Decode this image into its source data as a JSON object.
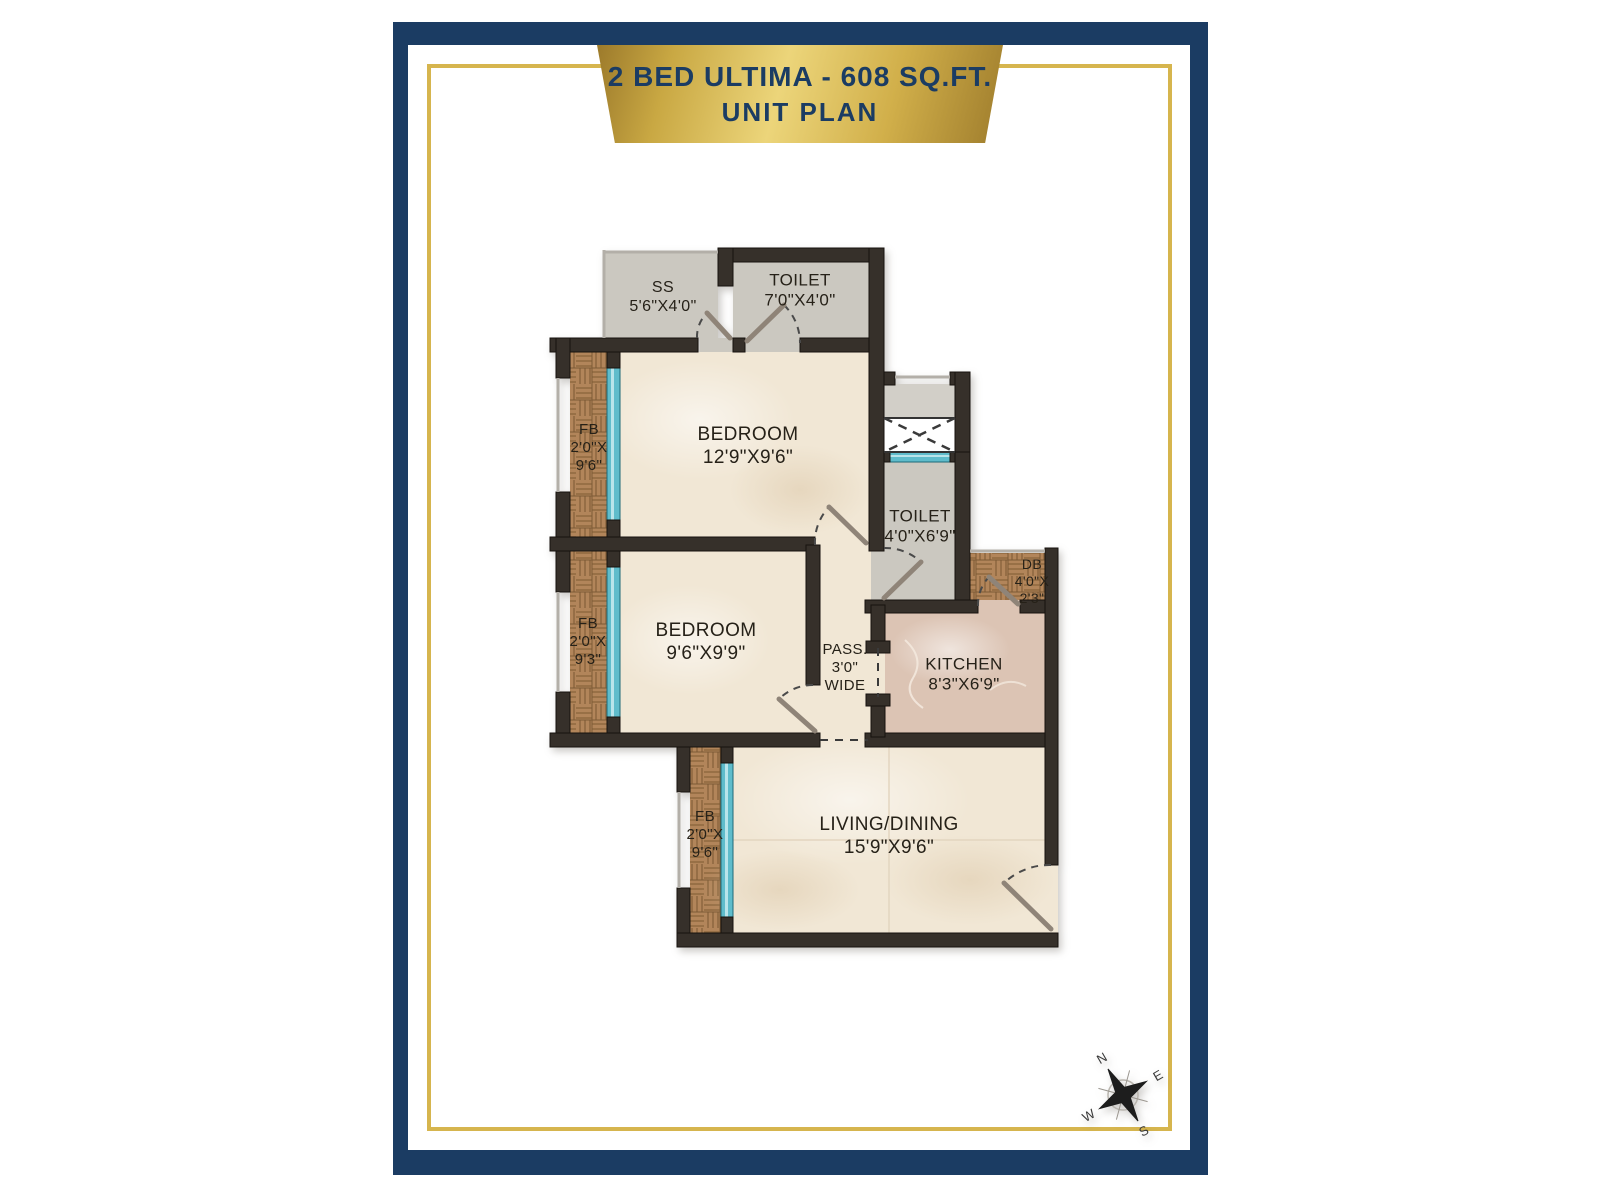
{
  "title": {
    "line1": "2 BED ULTIMA - 608 SQ.FT.",
    "line2": "UNIT PLAN"
  },
  "rooms": {
    "ss": {
      "lines": [
        "SS",
        "5'6\"X4'0\""
      ]
    },
    "toilet1": {
      "lines": [
        "TOILET",
        "7'0\"X4'0\""
      ]
    },
    "bedroom1": {
      "lines": [
        "BEDROOM",
        "12'9\"X9'6\""
      ]
    },
    "fb1": {
      "lines": [
        "FB",
        "2'0\"X",
        "9'6\""
      ]
    },
    "toilet2": {
      "lines": [
        "TOILET",
        "4'0\"X6'9\""
      ]
    },
    "db": {
      "lines": [
        "DB",
        "4'0\"X",
        "2'3\""
      ]
    },
    "bedroom2": {
      "lines": [
        "BEDROOM",
        "9'6\"X9'9\""
      ]
    },
    "fb2": {
      "lines": [
        "FB",
        "2'0\"X",
        "9'3\""
      ]
    },
    "passage": {
      "lines": [
        "PASS.",
        "3'0\"",
        "WIDE"
      ]
    },
    "kitchen": {
      "lines": [
        "KITCHEN",
        "8'3\"X6'9\""
      ]
    },
    "living": {
      "lines": [
        "LIVING/DINING",
        "15'9\"X9'6\""
      ]
    },
    "fb3": {
      "lines": [
        "FB",
        "2'0\"X",
        "9'6\""
      ]
    }
  },
  "compass": {
    "n": "N",
    "e": "E",
    "s": "S",
    "w": "W"
  },
  "colors": {
    "navy": "#1b3c63",
    "gold": "#d6b54e",
    "banner_gold_light": "#ecd57a",
    "wall": "#36302a",
    "floor_cream": "#f1e7d5",
    "floor_gray": "#cbc8c0",
    "floor_kitchen": "#dcc4b4",
    "wood": "#b2855a",
    "window_teal": "#5fbccb"
  }
}
